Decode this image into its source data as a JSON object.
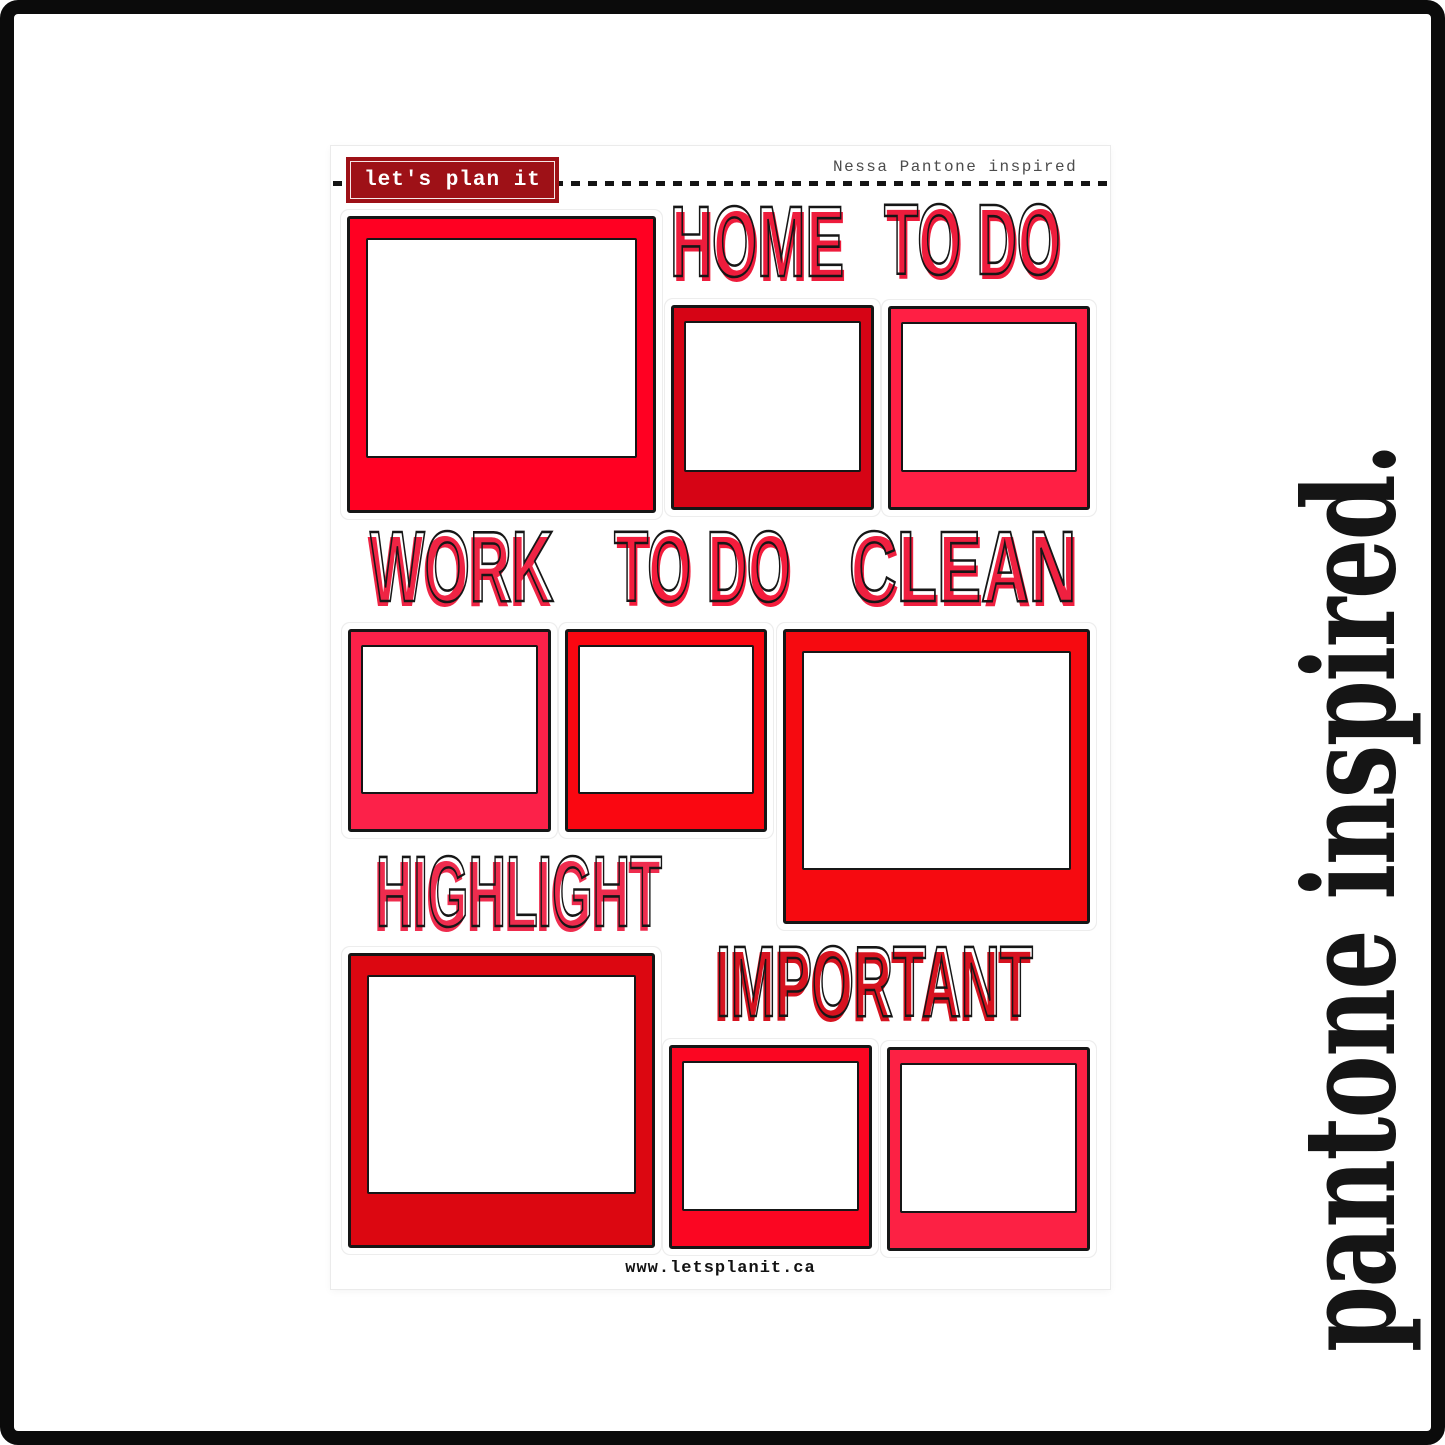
{
  "page": {
    "side_caption": "pantone inspired."
  },
  "sheet": {
    "logo_text": "let's plan it",
    "collection_label": "Nessa Pantone inspired",
    "website": "www.letsplanit.ca",
    "headings": [
      {
        "id": "home",
        "text": "HOME",
        "fill_style": "color:#EE1C3C"
      },
      {
        "id": "home-to-do",
        "text": "TO DO",
        "fill_style": "color:#EE1C3C"
      },
      {
        "id": "work",
        "text": "WORK",
        "fill_style": "color:#EF2444"
      },
      {
        "id": "work-to-do",
        "text": "TO DO",
        "fill_style": "color:#F41C3C"
      },
      {
        "id": "clean",
        "text": "CLEAN",
        "fill_style": "color:#EF2040"
      },
      {
        "id": "highlight",
        "text": "HIGHLIGHT",
        "fill_style": "color:#EF2C4E"
      },
      {
        "id": "important",
        "text": "IMPORTANT",
        "fill_style": "color:#D6121F"
      }
    ],
    "frames": [
      {
        "id": "home-large",
        "color": "#FF0022",
        "style": "background:#FF0022"
      },
      {
        "id": "home-small-1",
        "color": "#D60415",
        "style": "background:#D60415"
      },
      {
        "id": "home-small-2",
        "color": "#FF1F44",
        "style": "background:#FF1F44"
      },
      {
        "id": "work-small-1",
        "color": "#FC2149",
        "style": "background:#FC2149"
      },
      {
        "id": "work-small-2",
        "color": "#FA0711",
        "style": "background:#FA0711"
      },
      {
        "id": "clean-large",
        "color": "#F60A10",
        "style": "background:#F60A10"
      },
      {
        "id": "highlight-large",
        "color": "#DC0711",
        "style": "background:#DC0711"
      },
      {
        "id": "important-small-1",
        "color": "#FB0622",
        "style": "background:#FB0622"
      },
      {
        "id": "important-small-2",
        "color": "#FC2144",
        "style": "background:#FC2144"
      }
    ]
  },
  "colors": {
    "logo_bg": "#9E1117",
    "outline": "#161616",
    "border": "#0b0b0b",
    "side_text": "#151515"
  }
}
